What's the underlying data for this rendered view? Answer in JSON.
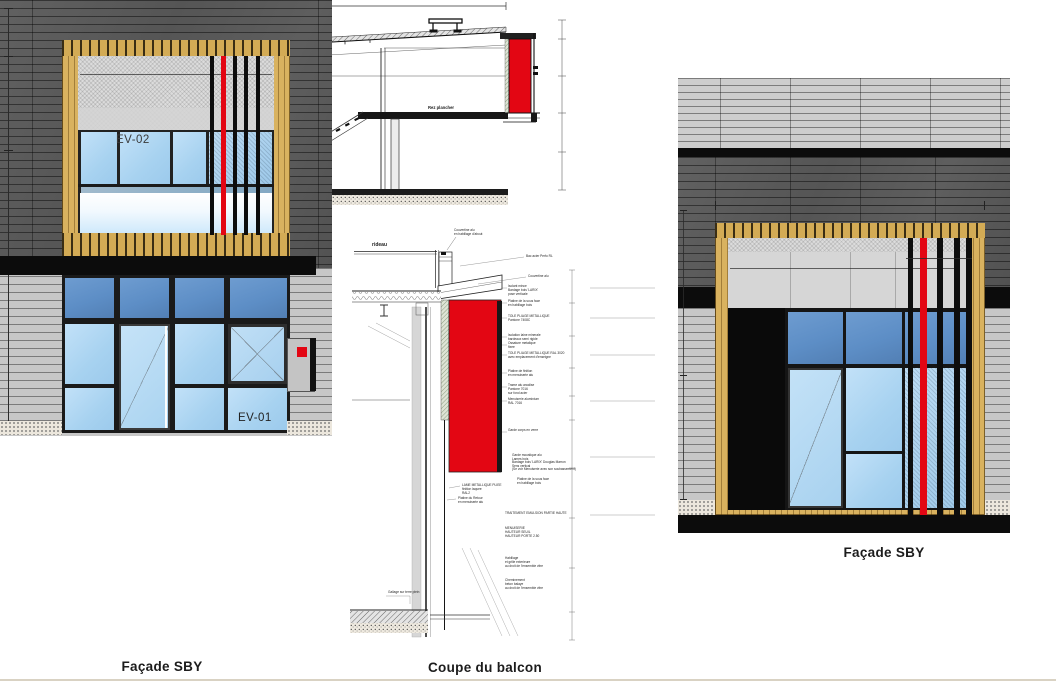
{
  "sheet": {
    "drawings": [
      "section",
      "facade_left",
      "coupe",
      "facade_right"
    ]
  },
  "colors": {
    "accent_red": "#e30613",
    "wood_frame": "#d9b25f",
    "cladding_dark": "#565656",
    "cladding_light": "#c7c7c7",
    "glass_light": "#a7d2f0",
    "glass_transom": "#5d8ec6",
    "bar_black": "#0d0d0d"
  },
  "section": {
    "slope_label": "Pente 3 %",
    "floor_label": "Rez plancher"
  },
  "facade_left": {
    "caption": "Façade SBY",
    "upper_window_label": "EV-02",
    "lower_window_label": "EV-01"
  },
  "facade_right": {
    "caption": "Façade SBY"
  },
  "coupe": {
    "caption": "Coupe du balcon",
    "curtain_wall_label": "rideau",
    "annotations": [
      {
        "x": 104,
        "y": 1,
        "text": "Couvertine alu\nen habillage d'about"
      },
      {
        "x": 176,
        "y": 27,
        "text": "Bac acier Perfo RL"
      },
      {
        "x": 178,
        "y": 47,
        "text": "Couvertine alu"
      },
      {
        "x": 158,
        "y": 57,
        "text": "Isolant mince\nBardage bois 'LARIX'\npose verticale"
      },
      {
        "x": 158,
        "y": 72,
        "text": "Platine de la sous face\nen habillage bois"
      },
      {
        "x": 158,
        "y": 87,
        "text": "TOLE PLIAGE METALLIQUE\nPantone 7408C"
      },
      {
        "x": 158,
        "y": 106,
        "text": "Isolation laine minerale\nbardeaux semi rigide"
      },
      {
        "x": 158,
        "y": 114,
        "text": "Ossature metalique\nfixee"
      },
      {
        "x": 158,
        "y": 124,
        "text": "TOLE PLIAGE METALLIQUE RAL 3020\navec emplacement d'enseigne"
      },
      {
        "x": 158,
        "y": 142,
        "text": "Platine de finition\nen menuiserie alu"
      },
      {
        "x": 158,
        "y": 156,
        "text": "Trame alu anodise\nPantone 7016\nsur fond acier"
      },
      {
        "x": 158,
        "y": 170,
        "text": "Menuiserie aluminium\nRAL 7016"
      },
      {
        "x": 158,
        "y": 201,
        "text": "Garde corps en verre"
      },
      {
        "x": 162,
        "y": 226,
        "text": "Garde moustique alu\nLames bois"
      },
      {
        "x": 162,
        "y": 233,
        "text": "Bardage bois 'LARIX' Douglas Marron\nSens vertical"
      },
      {
        "x": 162,
        "y": 240,
        "text": "(Se voir Menuiserie avec son soubassement)"
      },
      {
        "x": 167,
        "y": 250,
        "text": "Platine de la sous face\nen habillage bois"
      },
      {
        "x": 112,
        "y": 256,
        "text": "LAME METALLIQUE PLIEE\nfinition laquee\nRAL2"
      },
      {
        "x": 108,
        "y": 269,
        "text": "Platine du Retour\nen menuiserie alu"
      },
      {
        "x": 155,
        "y": 284,
        "text": "TRAITEMENT EMULSION PARTIE HAUTE"
      },
      {
        "x": 155,
        "y": 299,
        "text": "MENUISERIE\nHAUTEUR SEUIL\nHAUTEUR PORTE 2.50"
      },
      {
        "x": 155,
        "y": 329,
        "text": "Habillage\net grille exterieure\nau droit de l'ensemble vitre"
      },
      {
        "x": 155,
        "y": 351,
        "text": "Cheminement\nbeton balaye\nau droit de l'ensemble vitre"
      },
      {
        "x": 38,
        "y": 363,
        "text": "Gallage sur terre plein"
      }
    ]
  }
}
